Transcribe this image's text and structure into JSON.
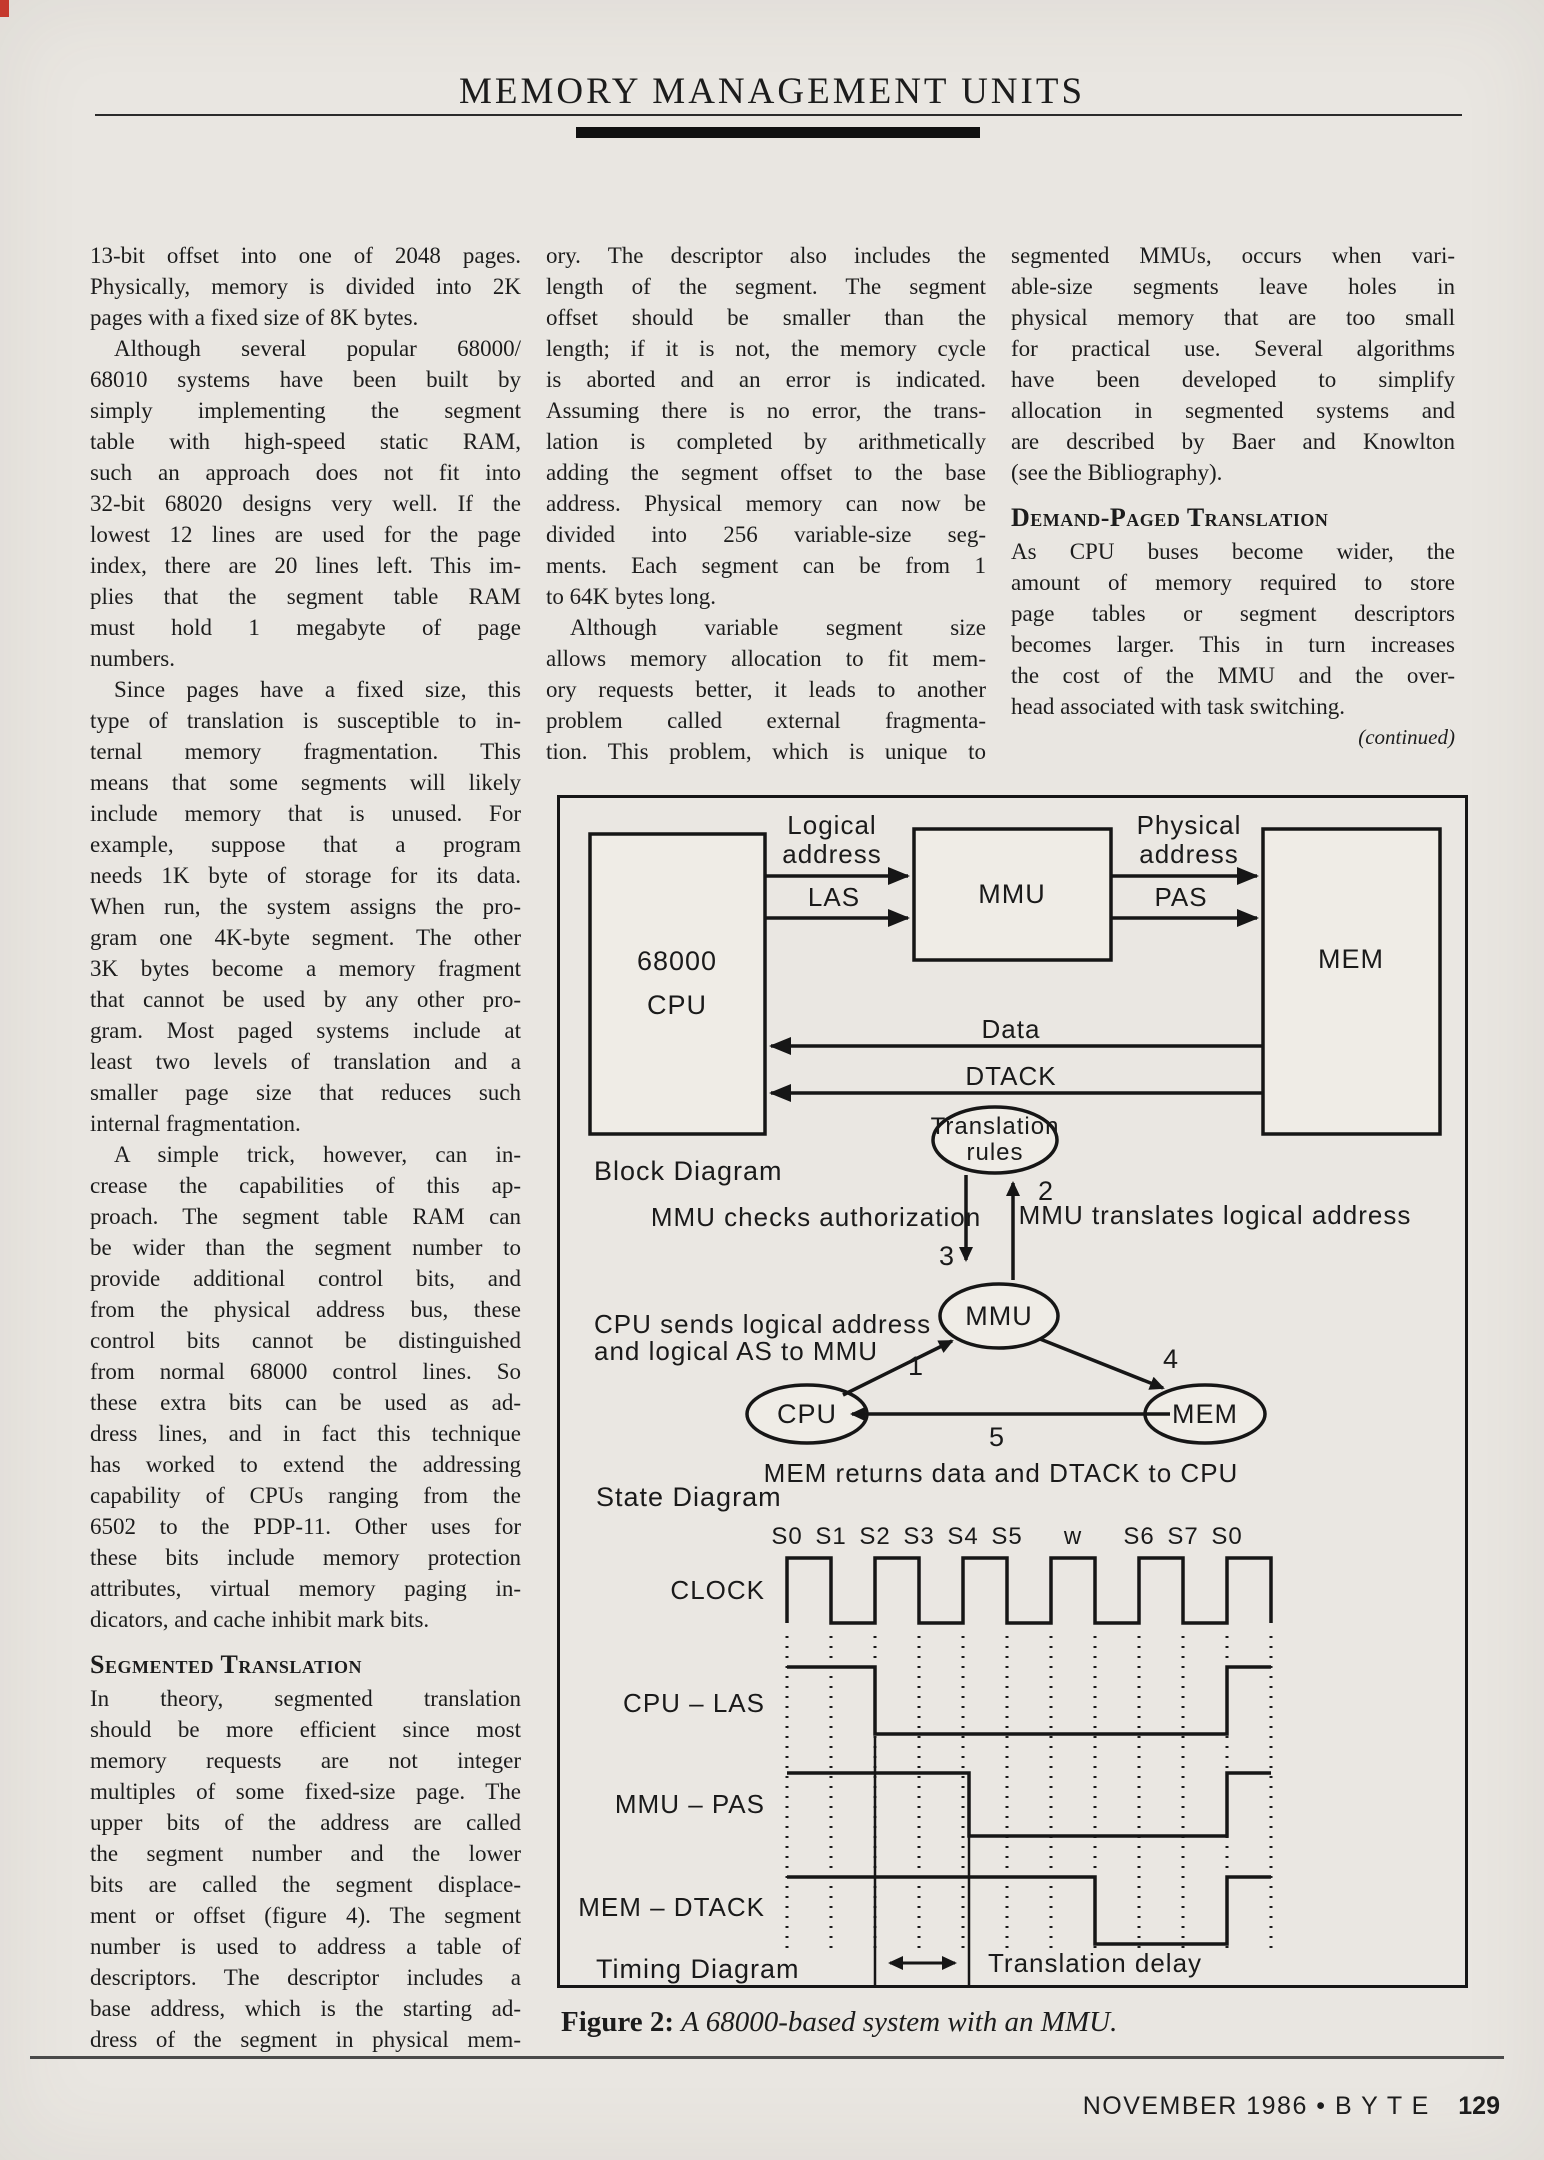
{
  "page": {
    "header_title": "MEMORY MANAGEMENT UNITS",
    "caption_label": "Figure 2:",
    "caption_text": "A 68000-based system with an MMU.",
    "footer_text": "NOVEMBER 1986 • B Y T E",
    "footer_page": "129"
  },
  "columns": [
    {
      "blocks": [
        {
          "type": "p",
          "indent": false,
          "cont": false,
          "lines": [
            "13-bit offset into one of 2048 pages.",
            "Physically, memory is divided into 2K",
            "pages with a fixed size of 8K bytes."
          ]
        },
        {
          "type": "p",
          "indent": true,
          "cont": false,
          "lines": [
            "Although several popular 68000/",
            "68010 systems have been built by",
            "simply implementing the segment",
            "table with high-speed static RAM,",
            "such an approach does not fit into",
            "32-bit 68020 designs very well. If the",
            "lowest 12 lines are used for the page",
            "index, there are 20 lines left. This im-",
            "plies that the segment table RAM",
            "must hold 1 megabyte of page",
            "numbers."
          ]
        },
        {
          "type": "p",
          "indent": true,
          "cont": false,
          "lines": [
            "Since pages have a fixed size, this",
            "type of translation is susceptible to in-",
            "ternal memory fragmentation. This",
            "means that some segments will likely",
            "include memory that is unused. For",
            "example, suppose that a program",
            "needs 1K byte of storage for its data.",
            "When run, the system assigns the pro-",
            "gram one 4K-byte segment. The other",
            "3K bytes become a memory fragment",
            "that cannot be used by any other pro-",
            "gram. Most paged systems include at",
            "least two levels of translation and a",
            "smaller page size that reduces such",
            "internal fragmentation."
          ]
        },
        {
          "type": "p",
          "indent": true,
          "cont": false,
          "lines": [
            "A simple trick, however, can in-",
            "crease the capabilities of this ap-",
            "proach. The segment table RAM can",
            "be wider than the segment number to",
            "provide additional control bits, and",
            "from the physical address bus, these",
            "control bits cannot be distinguished",
            "from normal 68000 control lines. So",
            "these extra bits can be used as ad-",
            "dress lines, and in fact this technique",
            "has worked to extend the addressing",
            "capability of CPUs ranging from the",
            "6502 to the PDP-11. Other uses for",
            "these bits include memory protection",
            "attributes, virtual memory paging in-",
            "dicators, and cache inhibit mark bits."
          ]
        },
        {
          "type": "h",
          "text": "Segmented Translation"
        },
        {
          "type": "p",
          "indent": false,
          "cont": true,
          "lines": [
            "In theory, segmented translation",
            "should be more efficient since most",
            "memory requests are not integer",
            "multiples of some fixed-size page. The",
            "upper bits of the address are called",
            "the segment number and the lower",
            "bits are called the segment displace-",
            "ment or offset (figure 4). The segment",
            "number is used to address a table of",
            "descriptors. The descriptor includes a",
            "base address, which is the starting ad-",
            "dress of the segment in physical mem-"
          ]
        }
      ]
    },
    {
      "blocks": [
        {
          "type": "p",
          "indent": false,
          "cont": false,
          "lines": [
            "ory. The descriptor also includes the",
            "length of the segment. The segment",
            "offset should be smaller than the",
            "length; if it is not, the memory cycle",
            "is aborted and an error is indicated.",
            "Assuming there is no error, the trans-",
            "lation is completed by arithmetically",
            "adding the segment offset to the base",
            "address. Physical memory can now be",
            "divided into 256 variable-size seg-",
            "ments. Each segment can be from 1",
            "to 64K bytes long."
          ]
        },
        {
          "type": "p",
          "indent": true,
          "cont": true,
          "lines": [
            "Although variable segment size",
            "allows memory allocation to fit mem-",
            "ory requests better, it leads to another",
            "problem called external fragmenta-",
            "tion. This problem, which is unique to"
          ]
        }
      ]
    },
    {
      "blocks": [
        {
          "type": "p",
          "indent": false,
          "cont": false,
          "lines": [
            "segmented MMUs, occurs when vari-",
            "able-size segments leave holes in",
            "physical memory that are too small",
            "for practical use. Several algorithms",
            "have been developed to simplify",
            "allocation in segmented systems and",
            "are described by Baer and Knowlton",
            "(see the Bibliography)."
          ]
        },
        {
          "type": "h",
          "text": "Demand-Paged Translation"
        },
        {
          "type": "p",
          "indent": false,
          "cont": false,
          "lines": [
            "As CPU buses become wider, the",
            "amount of memory required to store",
            "page tables or segment descriptors",
            "becomes larger. This in turn increases",
            "the cost of the MMU and the over-",
            "head associated with task switching."
          ]
        },
        {
          "type": "note",
          "text": "(continued)"
        }
      ]
    }
  ],
  "figure": {
    "block": {
      "cpu1": "68000",
      "cpu2": "CPU",
      "mmu": "MMU",
      "mem": "MEM",
      "logical1": "Logical",
      "logical2": "address",
      "las": "LAS",
      "physical1": "Physical",
      "physical2": "address",
      "pas": "PAS",
      "data": "Data",
      "dtack": "DTACK",
      "label": "Block Diagram"
    },
    "state": {
      "tr1": "Translation",
      "tr2": "rules",
      "mmu": "MMU",
      "cpu": "CPU",
      "mem": "MEM",
      "n1": "1",
      "n2": "2",
      "n3": "3",
      "n4": "4",
      "n5": "5",
      "checks": "MMU checks authorization",
      "translates": "MMU translates logical address",
      "sends1": "CPU sends logical address",
      "sends2": "and logical AS to MMU",
      "returns": "MEM returns data and DTACK to CPU",
      "label": "State Diagram"
    },
    "timing": {
      "states": [
        "S0",
        "S1",
        "S2",
        "S3",
        "S4",
        "S5",
        "w",
        "S6",
        "S7",
        "S0"
      ],
      "signals": [
        "CLOCK",
        "CPU – LAS",
        "MMU – PAS",
        "MEM – DTACK"
      ],
      "signal_behavior": [
        "CLOCK: continuous square wave across S0–S0 including wait state w",
        "CPU – LAS: high from S0, falls at S2, rises again at final S0",
        "MMU – PAS: high from S0, falls just after S4, rises again at final S0",
        "MEM – DTACK: high from S0, falls before S6, rises again at final S0"
      ],
      "delay_label": "Translation delay",
      "label": "Timing Diagram"
    }
  }
}
